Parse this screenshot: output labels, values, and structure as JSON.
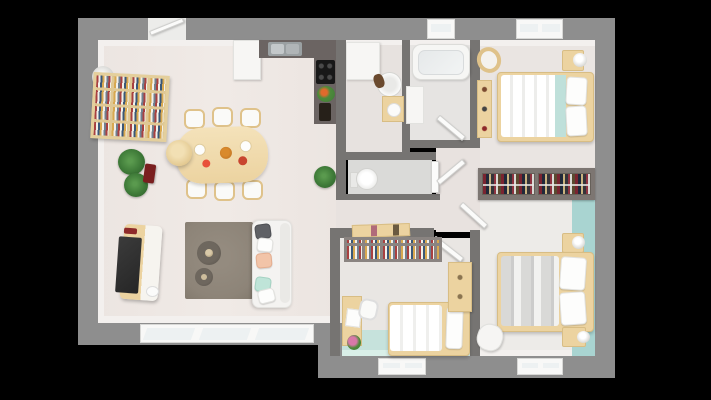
{
  "scene": {
    "kind": "3d-floorplan-top-down-render",
    "background": "#000000",
    "no_visible_text": true
  },
  "palette": {
    "bg": "#000000",
    "wall": "#8e8e8e",
    "walldark": "#767472",
    "wallface": "#f3f0ee",
    "floorliving": "#ece5e1",
    "floorbed": "#eae5e2",
    "floorkid": "#e9e6e3",
    "floorwc": "#dadad8",
    "mint": "#c6e2dc",
    "teal": "#a9d4d1",
    "tealbed": "#bfe0da",
    "wood": "#ecd3a0",
    "wooddark": "#dfc28a",
    "shelfwood": "#dfc894",
    "counter": "#6b6462",
    "cooktop": "#181818",
    "whitefurn": "#f7f6f4",
    "winframe": "#f8f8f7",
    "glass": "#edf1f2",
    "rug": "#8d8478",
    "tv": "#2f2f2f",
    "sofa": "#f4f3f1",
    "plant": "#3e7a38",
    "graybed": "#d9d9d7",
    "pillowpeach": "#f2c4a8",
    "pillowmint": "#bfe4d8",
    "pillowgray": "#5f6165",
    "winebottle": "#7a1f1f",
    "rackframe": "#7d7672"
  },
  "rooms": [
    {
      "name": "living-dining-kitchen",
      "furniture": [
        "entrance-door",
        "fridge-cabinet",
        "kitchen-counter",
        "kitchen-sink",
        "cooktop",
        "flower-vase",
        "wine-bottles",
        "bookshelf",
        "floor-lamp",
        "plants",
        "wine-rack",
        "pendant-lamp",
        "dining-table",
        "dining-chairs-x6",
        "tv-console",
        "tv",
        "rug",
        "coffee-tables-x2",
        "sofa",
        "bay-windows"
      ]
    },
    {
      "name": "bathroom",
      "furniture": [
        "cabinet-washer",
        "round-sink",
        "towel",
        "vanity"
      ]
    },
    {
      "name": "bathroom-bathtub",
      "furniture": [
        "bathtub",
        "vanity",
        "window"
      ]
    },
    {
      "name": "wc",
      "furniture": [
        "toilet",
        "door"
      ]
    },
    {
      "name": "hallway",
      "furniture": [
        "open-doors-x3",
        "plant"
      ]
    },
    {
      "name": "bedroom-1",
      "furniture": [
        "double-bed-teal-runner",
        "nightstand",
        "table-lamp",
        "armchair",
        "shelf",
        "window",
        "open-wardrobe-racks"
      ]
    },
    {
      "name": "bedroom-2",
      "furniture": [
        "double-bed-gray",
        "nightstand-x2",
        "table-lamp",
        "pouf",
        "window",
        "teal-accent-floor"
      ]
    },
    {
      "name": "kids-bedroom",
      "furniture": [
        "wall-bookshelf",
        "storage-box",
        "desk",
        "desk-chair",
        "flowers",
        "single-bed",
        "wardrobe",
        "window",
        "mint-floor",
        "door"
      ]
    }
  ]
}
